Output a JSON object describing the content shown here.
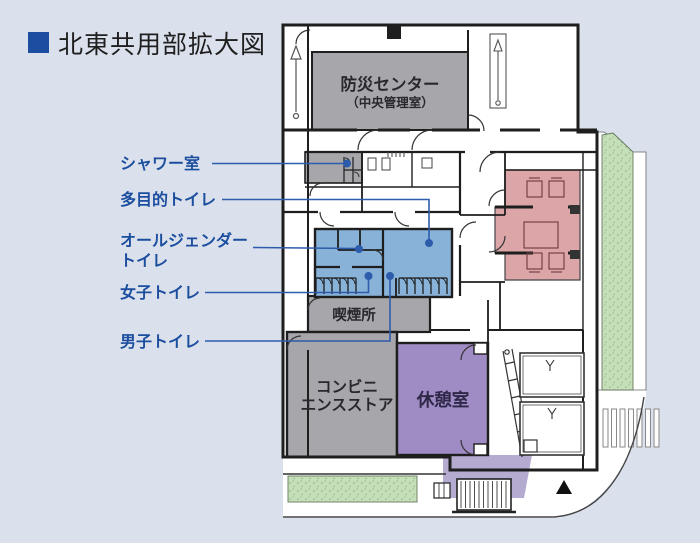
{
  "title": {
    "text": "北東共用部拡大図"
  },
  "callouts": {
    "shower": {
      "label": "シャワー室"
    },
    "multipurpose": {
      "label": "多目的トイレ"
    },
    "all_gender": {
      "line1": "オールジェンダー",
      "line2": "トイレ"
    },
    "women": {
      "label": "女子トイレ"
    },
    "men": {
      "label": "男子トイレ"
    }
  },
  "rooms": {
    "disaster_center": {
      "line1": "防災センター",
      "line2": "（中央管理室）"
    },
    "smoking_area": {
      "label": "喫煙所"
    },
    "convenience_store": {
      "line1": "コンビニ",
      "line2": "エンスストア"
    },
    "rest_room": {
      "label": "休憩室"
    }
  },
  "colors": {
    "page_bg": "#dbe1ec",
    "plan_white": "#ffffff",
    "room_gray": "#a7a7ab",
    "toilet_blue": "#88b2d7",
    "lounge_pink": "#dca6a9",
    "rest_purple": "#a08cc5",
    "ext_purple": "#b5abd1",
    "green": "#c5dfba",
    "green_dot": "#8fb183",
    "accent_blue": "#1b4e9e",
    "callout_blue": "#2d5cab",
    "wall": "#1e1e1e",
    "text_dark": "#28282c"
  }
}
